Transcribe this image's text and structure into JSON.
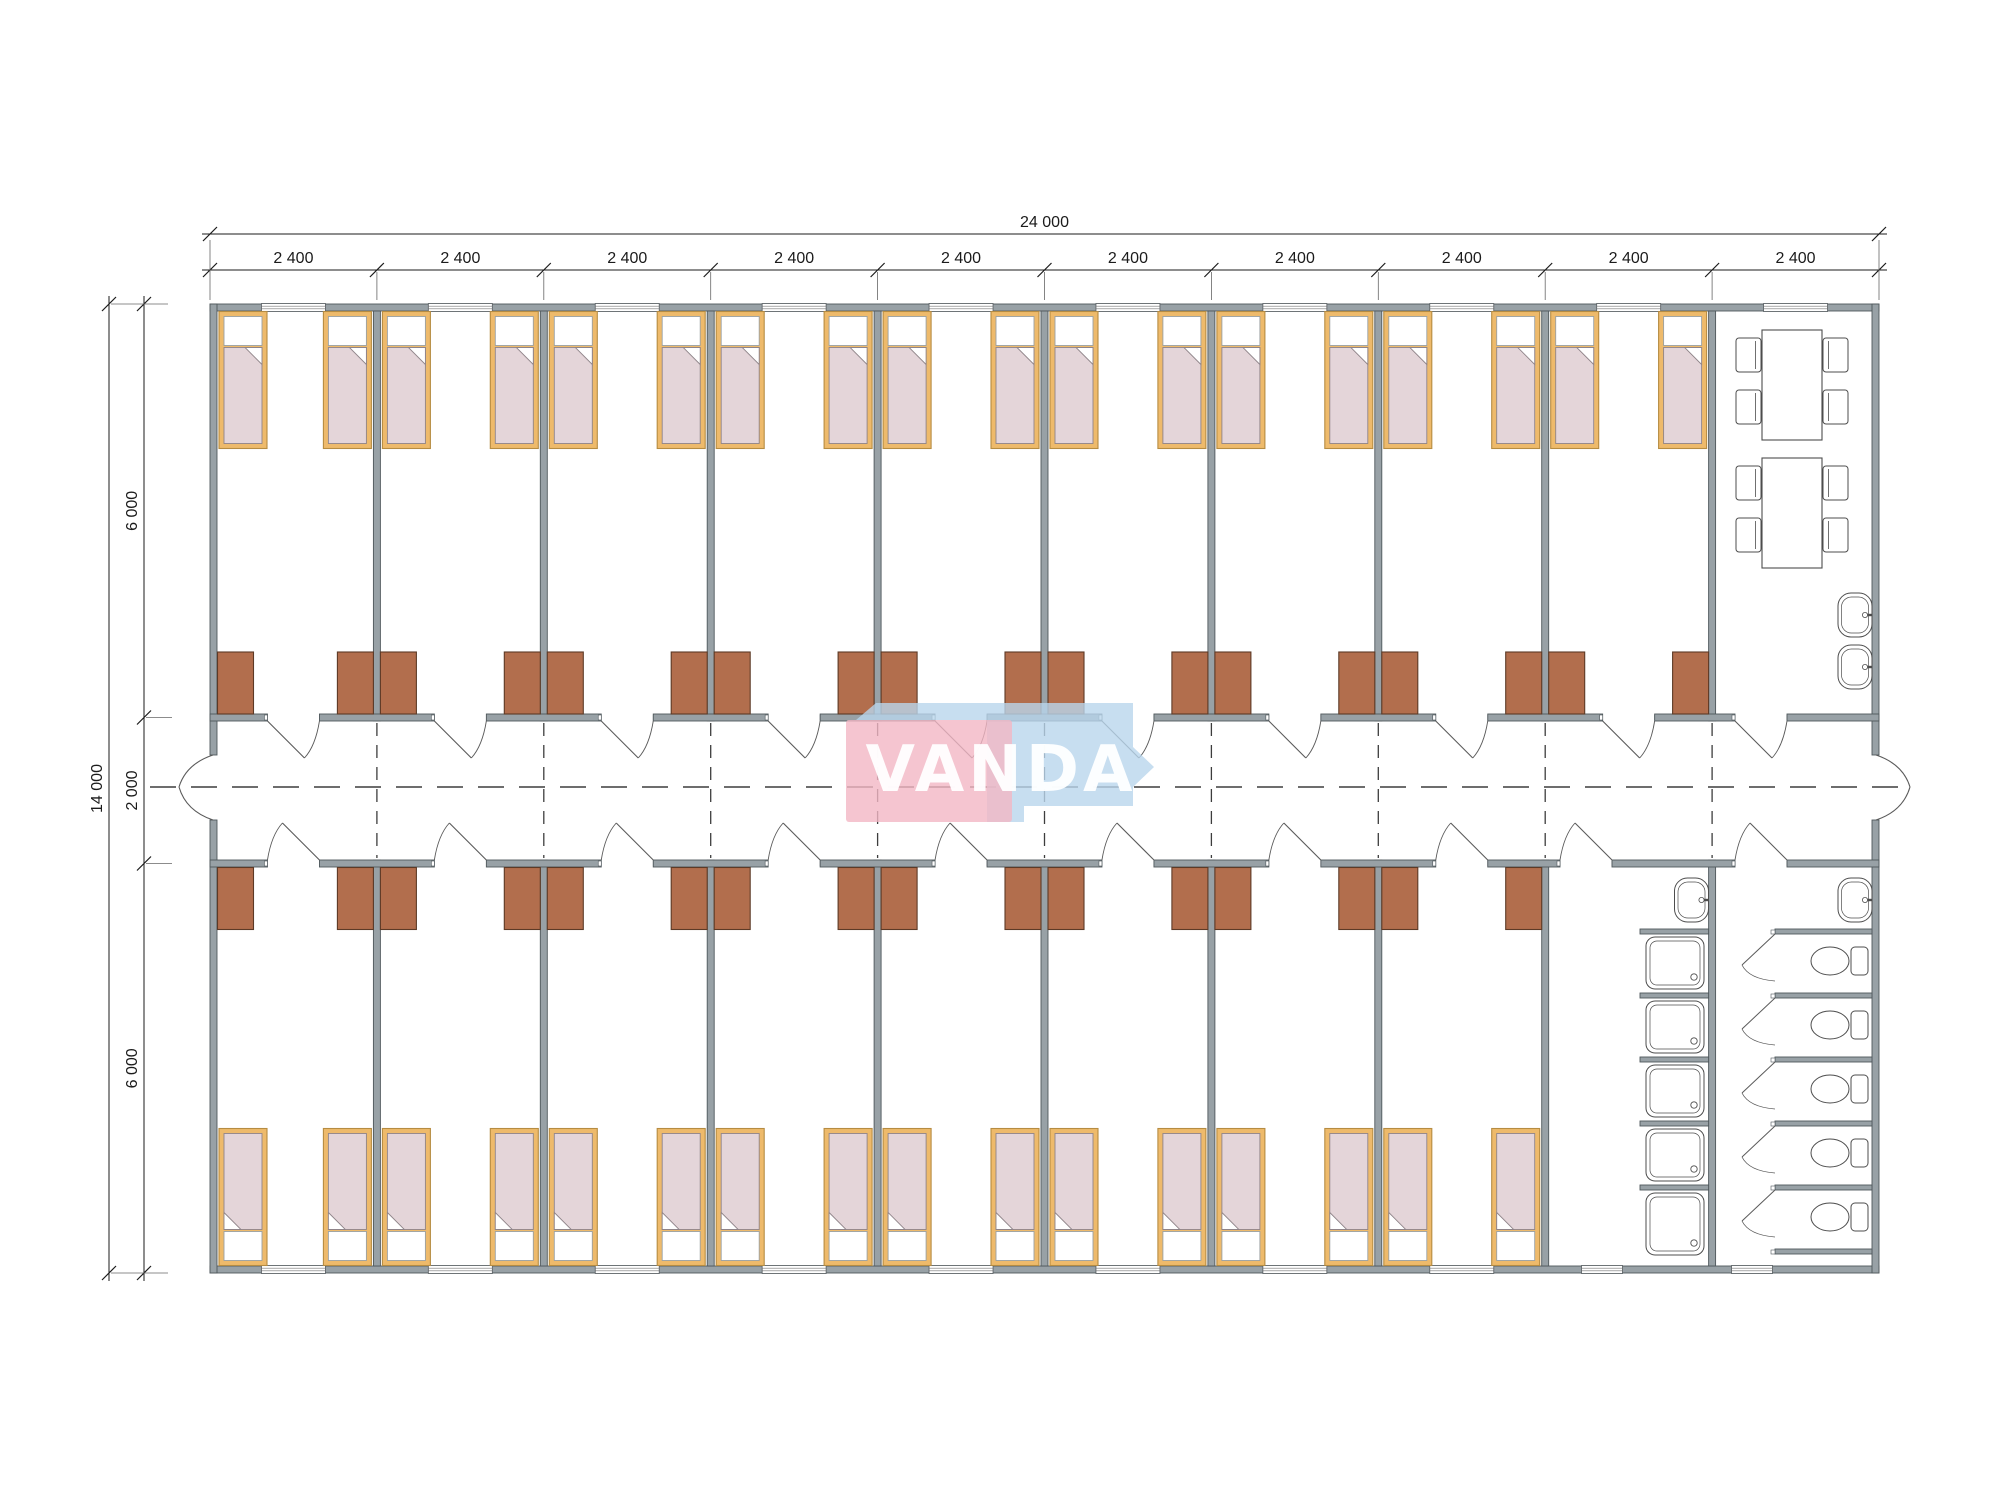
{
  "drawing": {
    "type": "architectural-floor-plan",
    "watermark": {
      "text": "VANDA",
      "pink": "#f3b6c4",
      "blue": "#b9d6ec",
      "text_color": "#ffffff"
    },
    "dimensions": {
      "top_total": "24 000",
      "top_segments": [
        "2 400",
        "2 400",
        "2 400",
        "2 400",
        "2 400",
        "2 400",
        "2 400",
        "2 400",
        "2 400",
        "2 400"
      ],
      "left_total": "14 000",
      "left_segments": [
        "6 000",
        "2 000",
        "6 000"
      ]
    },
    "colors": {
      "wall": "#98a1a6",
      "wall_stroke": "#4f585c",
      "wardrobe": "#b26e4d",
      "wardrobe_stroke": "#5d3a26",
      "bed_frame": "#eeba6b",
      "bed_frame_stroke": "#b68c42",
      "pillow": "#ffffff",
      "pillow_stroke": "#9aa0a3",
      "blanket": "#e4d5d9",
      "blanket_stroke": "#8f8489",
      "fixture_stroke": "#4d4d4d",
      "door_stroke": "#5a5a5a",
      "dim": "#1b1b1b",
      "dash": "#3d3d3d",
      "background": "#ffffff"
    },
    "rooms": {
      "top_bedrooms": 9,
      "bottom_bedrooms": 8,
      "beds_per_room": 2,
      "dining_tables": 2,
      "chairs_per_table": 4
    },
    "fixtures": {
      "showers": 5,
      "toilets": 5,
      "sinks": 4,
      "wardrobes": 34
    }
  }
}
